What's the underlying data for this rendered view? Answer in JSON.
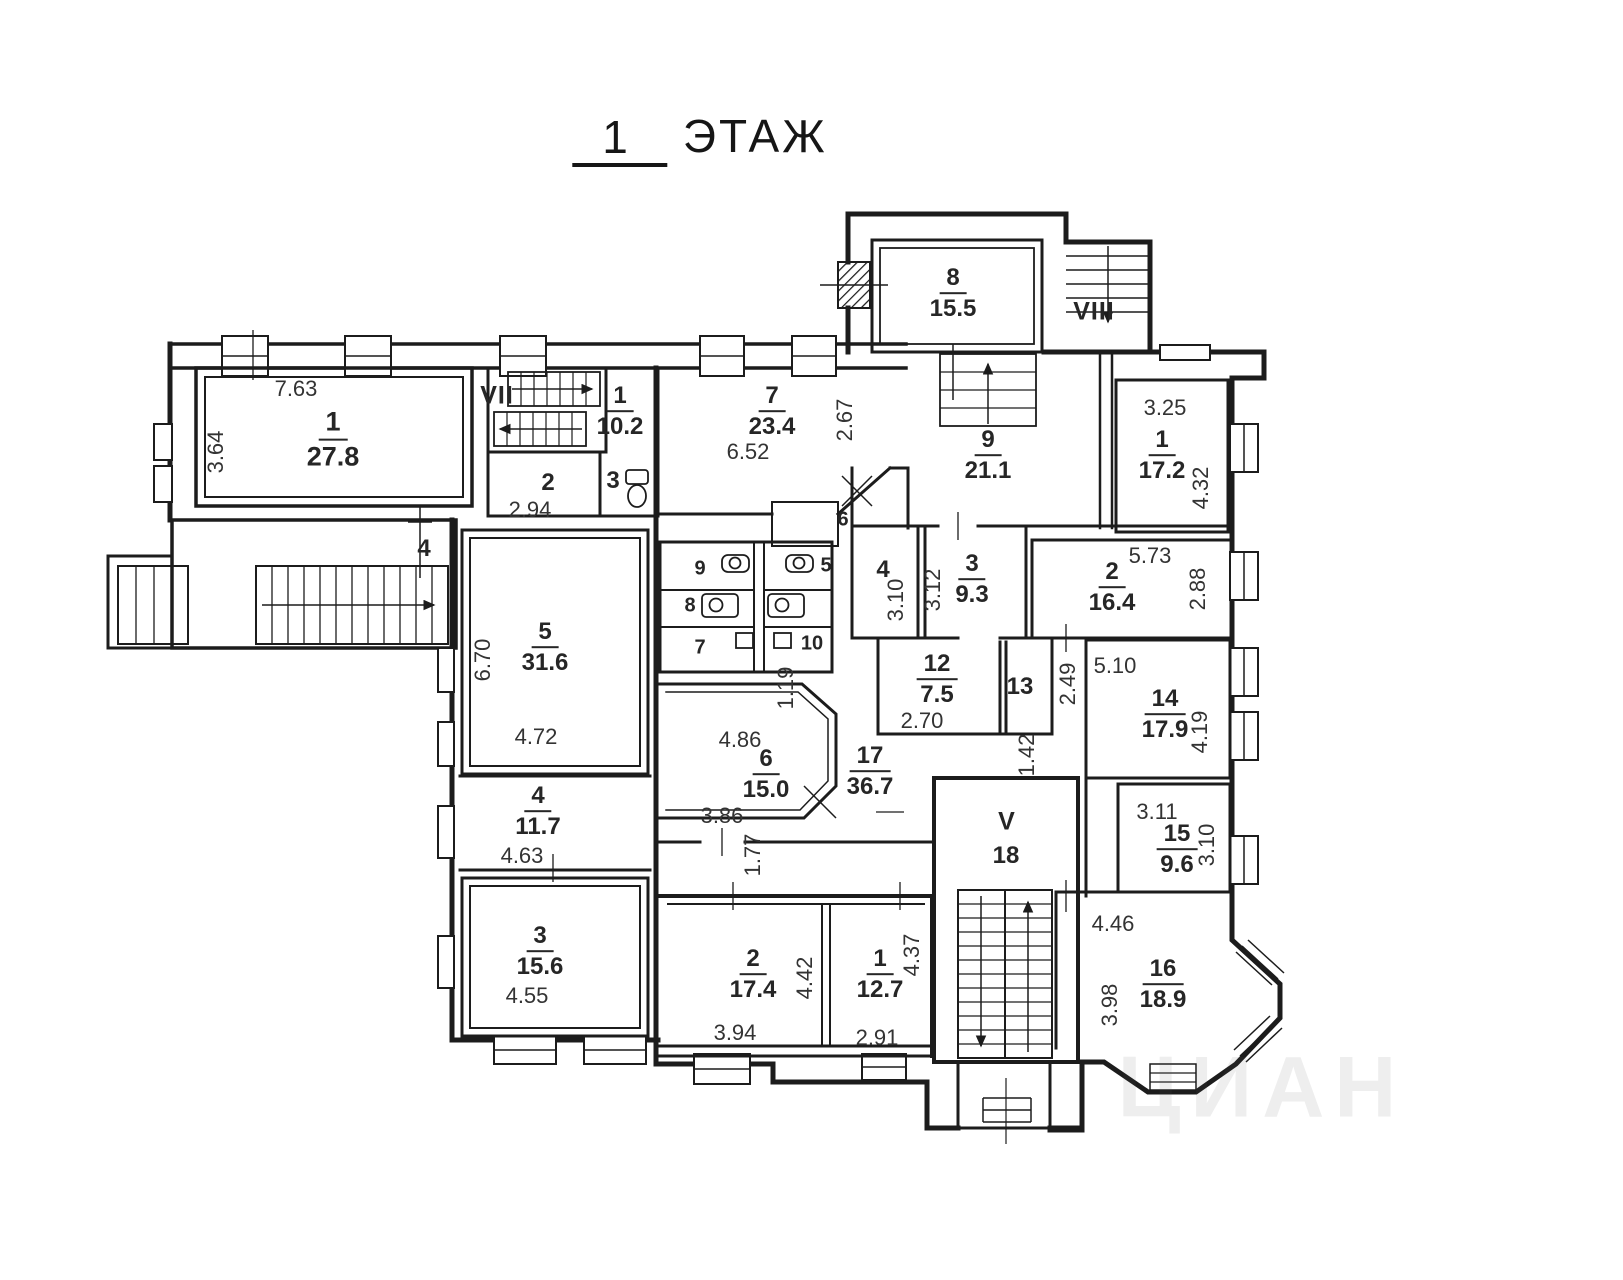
{
  "title": {
    "number": "1",
    "word": "ЭТАЖ"
  },
  "watermark": {
    "text": "ЦИАН"
  },
  "stairwells": {
    "vii": "VII",
    "viii": "VIII",
    "v": "V",
    "v_num": "18"
  },
  "rooms": {
    "l1": {
      "num": "1",
      "area": "27.8"
    },
    "lhall": {
      "num": "1",
      "area": "10.2"
    },
    "l2": {
      "num": "2",
      "area": "2.94"
    },
    "l3wc": {
      "num": "3"
    },
    "l4mark": {
      "num": "4"
    },
    "l5": {
      "num": "5",
      "area": "31.6"
    },
    "l4": {
      "num": "4",
      "area": "11.7"
    },
    "l3": {
      "num": "3",
      "area": "15.6"
    },
    "m7": {
      "num": "7",
      "area": "23.4"
    },
    "m6": {
      "num": "6",
      "area": "15.0"
    },
    "m17": {
      "num": "17",
      "area": "36.7"
    },
    "m12": {
      "num": "12",
      "area": "7.5"
    },
    "m13": {
      "num": "13"
    },
    "m14": {
      "num": "14",
      "area": "17.9"
    },
    "m15": {
      "num": "15",
      "area": "9.6"
    },
    "m16": {
      "num": "16",
      "area": "18.9"
    },
    "b2": {
      "num": "2",
      "area": "17.4"
    },
    "b1": {
      "num": "1",
      "area": "12.7"
    },
    "r8": {
      "num": "8",
      "area": "15.5"
    },
    "r9": {
      "num": "9",
      "area": "21.1"
    },
    "r1": {
      "num": "1",
      "area": "17.2"
    },
    "r4": {
      "num": "4"
    },
    "r3": {
      "num": "3",
      "area": "9.3"
    },
    "r2": {
      "num": "2",
      "area": "16.4"
    },
    "wc9": {
      "num": "9"
    },
    "wc8": {
      "num": "8"
    },
    "wc7": {
      "num": "7"
    },
    "wc5": {
      "num": "5"
    },
    "wc10": {
      "num": "10"
    },
    "wc6": {
      "num": "6"
    }
  },
  "dims": {
    "room_l1_width": "7.63",
    "room_l1_depth": "3.64",
    "room_m7_width": "6.52",
    "room_m7_depth": "2.67",
    "room_r1_width": "3.25",
    "room_r1_depth": "4.32",
    "room_r2_width": "5.73",
    "room_r2_depth": "2.88",
    "room_r4_depth": "3.10",
    "room_r3_depth": "3.12",
    "room_l5_depth": "6.70",
    "room_l5_width": "4.72",
    "room_l4_width": "4.63",
    "room_l3_width": "4.55",
    "room_m6_width": "4.86",
    "room_m6_width2": "3.86",
    "wc_passage": "1.19",
    "corridor_passage": "1.77",
    "room_b2_depth": "4.42",
    "room_b2_width": "3.94",
    "room_b1_depth": "4.37",
    "room_b1_width": "2.91",
    "room_m12_width": "2.70",
    "room_m13_depth": "2.49",
    "corridor_width": "5.10",
    "room_m14_depth": "4.19",
    "corridor_neck": "1.42",
    "room_m15_width": "3.11",
    "room_m15_depth": "3.10",
    "room_m16_width": "4.46",
    "room_m16_depth": "3.98"
  }
}
